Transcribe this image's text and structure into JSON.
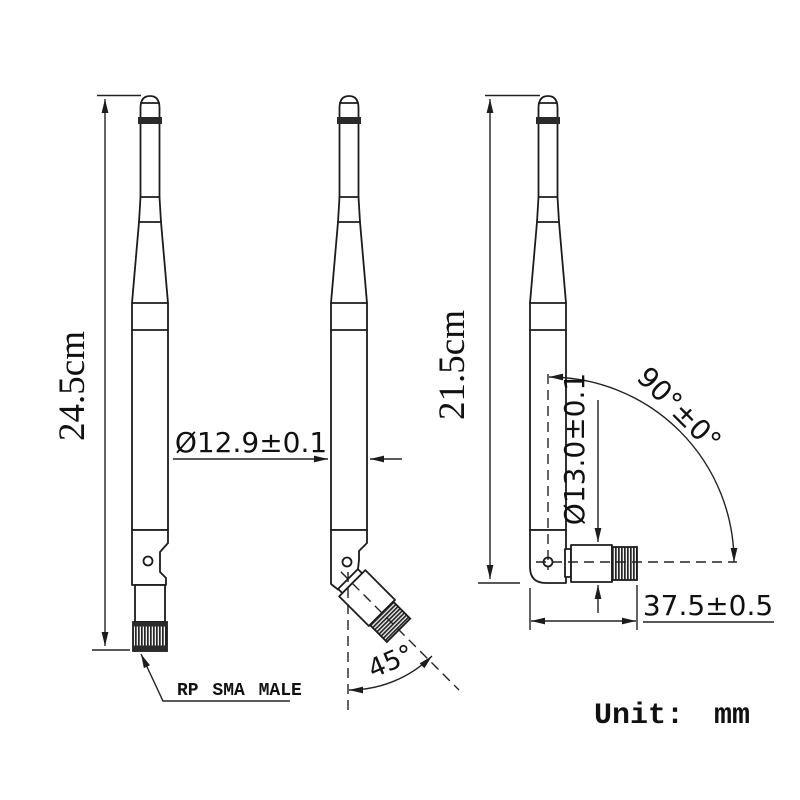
{
  "drawing": {
    "unit_label": "Unit: mm",
    "views": {
      "straight": {
        "height_label": "24.5cm",
        "connector_label": "RP SMA MALE"
      },
      "bent45": {
        "diameter_label": "Ø12.9±0.1",
        "angle_label": "45°"
      },
      "bent90": {
        "height_label": "21.5cm",
        "diameter_label": "Ø13.0±0.1",
        "angle_label": "90°±0°",
        "connector_width_label": "37.5±0.5"
      }
    },
    "colors": {
      "line": "#1c1c1c",
      "background": "#ffffff"
    }
  }
}
